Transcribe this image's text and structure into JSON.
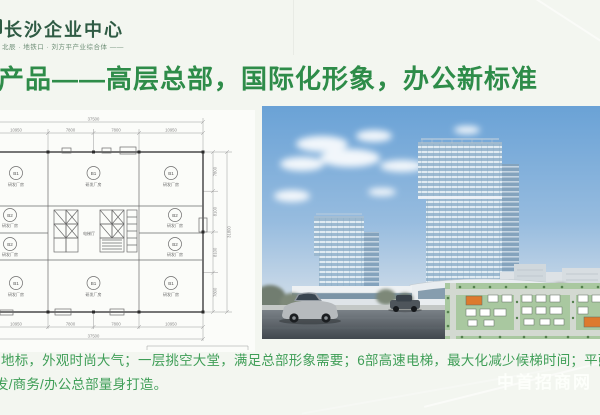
{
  "slide": {
    "header": {
      "logo_text": "·长沙企业中心",
      "tagline": "北辰 · 地铁口 · 刘方平产业综合体 ——"
    },
    "headline": "产品——高层总部，国际化形象，办公新标准",
    "floor_plan": {
      "total_width": "37500",
      "total_height": "31800",
      "top_dims": [
        "10950",
        "7800",
        "7800",
        "10950"
      ],
      "bottom_dims": [
        "10950",
        "7800",
        "7800",
        "10950"
      ],
      "right_dims": [
        "7800",
        "8100",
        "8100",
        "7800"
      ],
      "room_code_main": "B1",
      "room_code_side": "B2",
      "room_label": "研发厂房",
      "core_label": "电梯厅"
    },
    "body_text": {
      "line1": "地标，外观时尚大气；一层挑空大堂，满足总部形象需要；6部高速电梯，最大化减少候梯时间；平面",
      "line2": "发/商务/办公总部量身打造。"
    },
    "watermark": "中首招商网",
    "colors": {
      "headline_green": "#2e8c49",
      "logo_green": "#2f5b44",
      "body_green": "#3f9e57",
      "accent_orange": "#dd7a2e"
    }
  }
}
